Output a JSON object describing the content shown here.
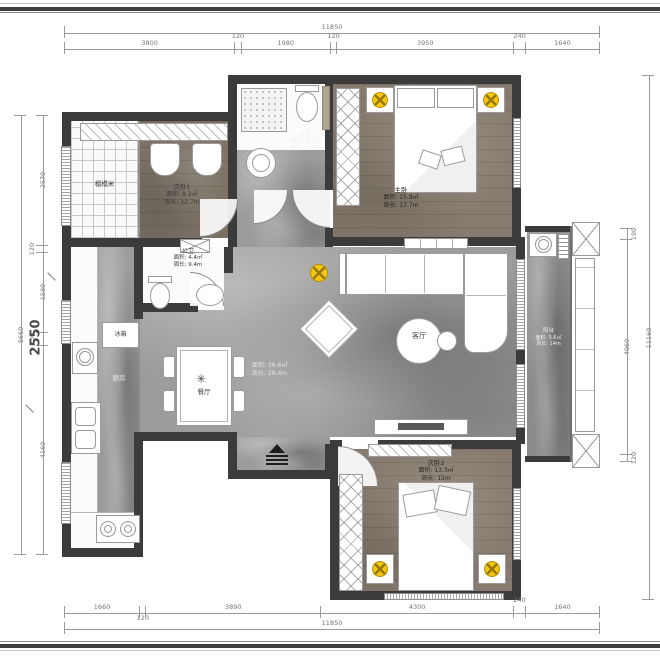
{
  "plan_title": "apartment-floor-plan",
  "colors": {
    "wall": "#3b3b3b",
    "marble_floor": "#9c9c9c",
    "wood_floor": "#867b6e",
    "light_accent": "#f3c614",
    "dim_line": "#9b9b9b"
  },
  "rooms": {
    "tatami": {
      "name": "榻榻米"
    },
    "bedroom1": {
      "name": "次卧1",
      "area": "面积: 9.2㎡",
      "perimeter": "周长: 12.7m"
    },
    "master_bath": {
      "name": "主卫",
      "area": "面积: 4.2㎡",
      "perimeter": "周长: 8.3m"
    },
    "master": {
      "name": "主卧",
      "area": "面积: 15.8㎡",
      "perimeter": "周长: 17.7m"
    },
    "guest_bath": {
      "name": "公卫",
      "area": "面积: 4.4㎡",
      "perimeter": "周长: 9.4m"
    },
    "kitchen": {
      "name": "厨房"
    },
    "fridge": {
      "name": "冰箱"
    },
    "dining": {
      "name": "餐厅"
    },
    "living": {
      "name": "客厅",
      "area": "面积: 36.6㎡",
      "perimeter": "周长: 28.4m"
    },
    "bedroom2": {
      "name": "次卧2",
      "area": "面积: 13.3㎡",
      "perimeter": "周长: 15m"
    },
    "balcony": {
      "name": "阳台",
      "area": "面积: 5.6㎡",
      "perimeter": "周长: 14m"
    }
  },
  "dims": {
    "top": {
      "total": "11850",
      "segments": [
        "3800",
        "120",
        "1980",
        "120",
        "3950",
        "240",
        "1640"
      ]
    },
    "bottom": {
      "total": "11850",
      "segments": [
        "1660",
        "120",
        "3890",
        "4300",
        "240",
        "1640"
      ]
    },
    "left": {
      "total": "8660",
      "segments": [
        "2570",
        "120",
        "1580",
        "230",
        "4160"
      ],
      "inner": "2550"
    },
    "right": {
      "total": "11160",
      "segments": [
        "190",
        "4060",
        "120"
      ]
    }
  },
  "icons": {
    "ceiling_light": "light-cross",
    "entry_marker": "entry-steps",
    "plant": "✳"
  }
}
